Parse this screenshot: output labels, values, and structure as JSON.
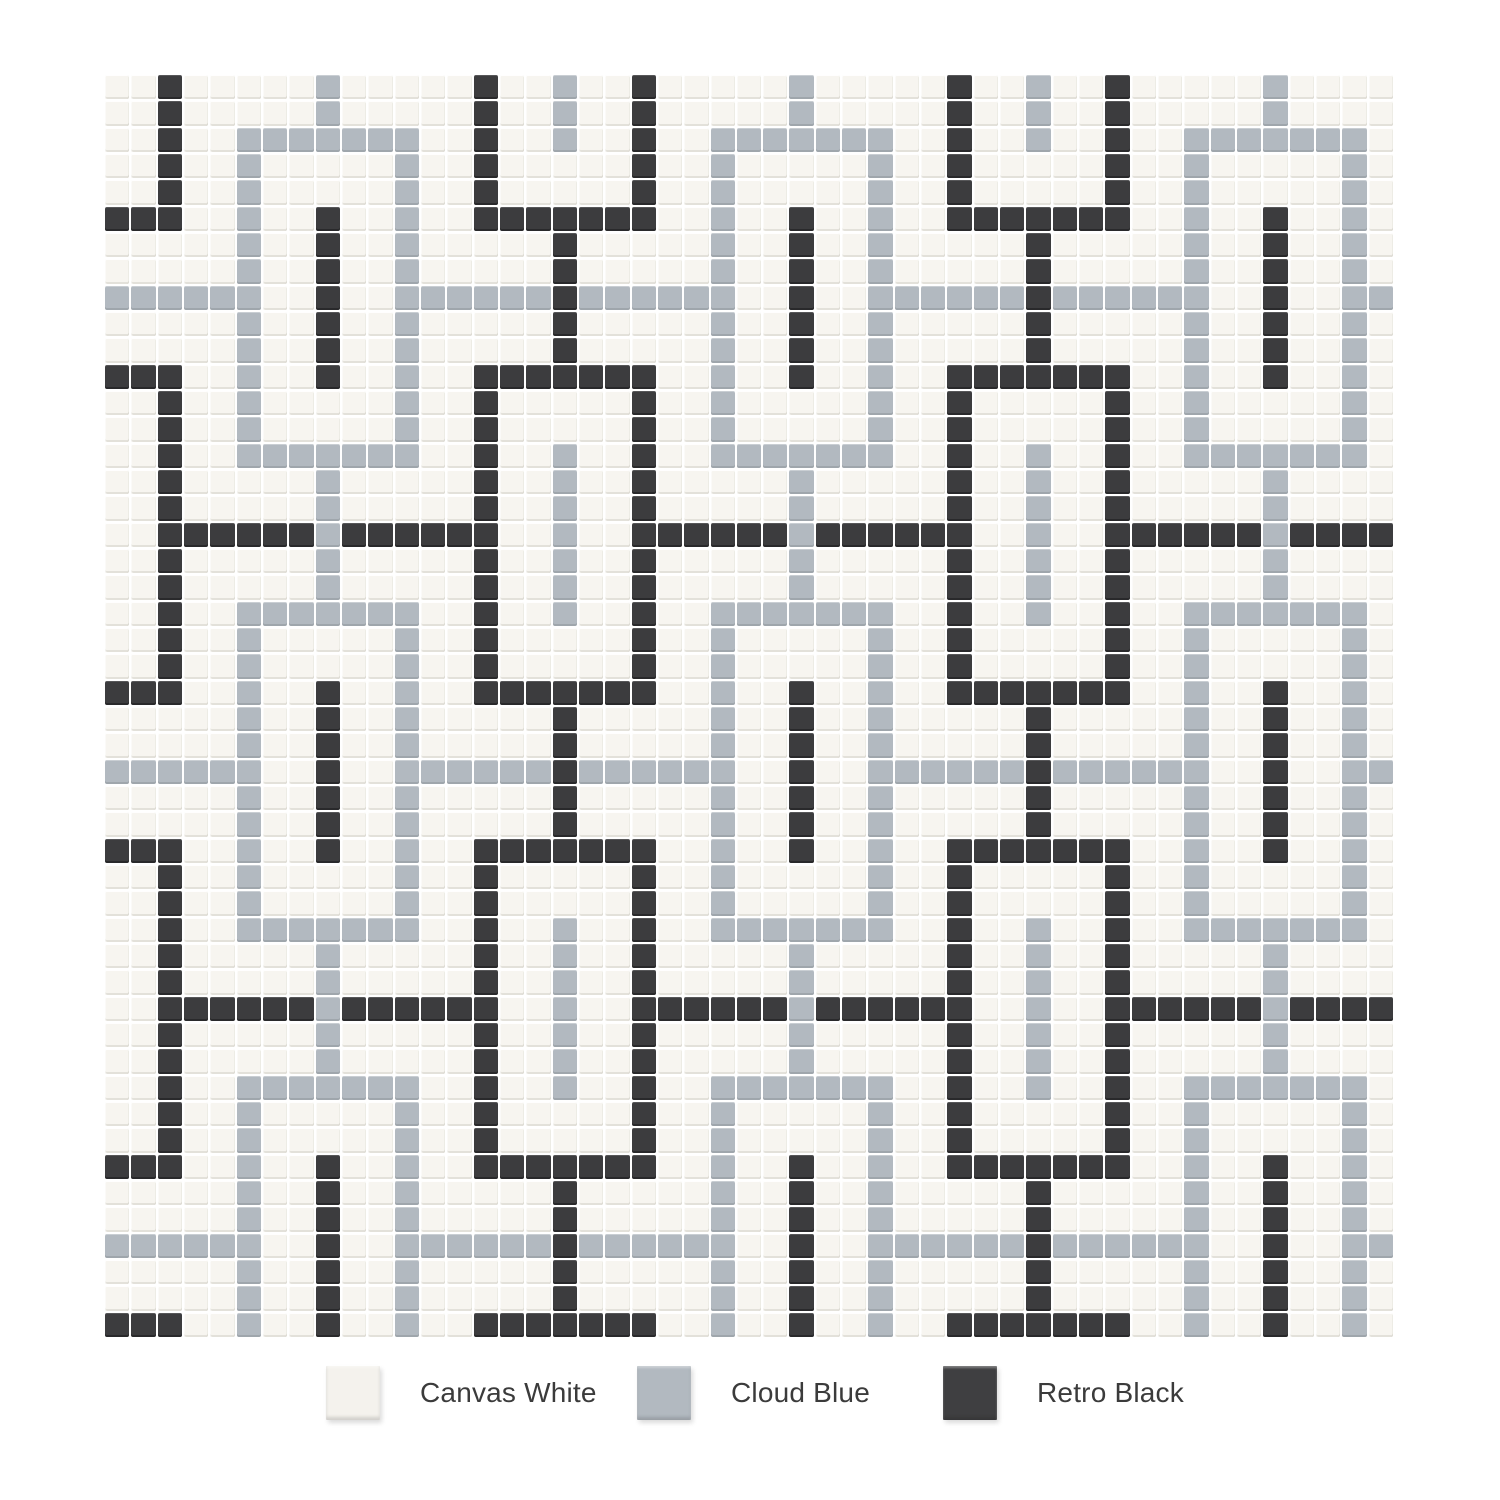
{
  "page": {
    "background": "#ffffff"
  },
  "mosaic": {
    "columns": 49,
    "rows": 48,
    "tile_gap_px": 2,
    "palette": {
      "W": "#f7f5f0",
      "B": "#b2b9c0",
      "D": "#3c3c3e"
    },
    "palette_names": {
      "W": "canvas-white",
      "B": "cloud-blue",
      "D": "retro-black"
    },
    "grid": [
      "WWDWWWWWBWWWWWDWWBWWDWWWWWBWWWWWDWWBWWDWWWWWBWWWW",
      "WWDWWWWWBWWWWWDWWBWWDWWWWWBWWWWWDWWBWWDWWWWWBWWWW",
      "WWDWWBBBBBBBWWDWWBWWDWWBBBBBBBWWDWWBWWDWWBBBBBBBW",
      "WWDWWBWWWWWBWWDWWWWWDWWBWWWWWBWWDWWWWWDWWBWWWWWBW",
      "WWDWWBWWWWWBWWDWWWWWDWWBWWWWWBWWDWWWWWDWWBWWWWWBW",
      "DDDWWBWWDWWBWWDDDDDDDWWBWWDWWBWWDDDDDDDWWBWWDWWBW",
      "WWWWWBWWDWWBWWWWWDWWWWWBWWDWWBWWWWWDWWWWWBWWDWWBW",
      "WWWWWBWWDWWBWWWWWDWWWWWBWWDWWBWWWWWDWWWWWBWWDWWBW",
      "BBBBBBWWDWWBBBBBBDBBBBBBWWDWWBBBBBBDBBBBBBWWDWWBB",
      "WWWWWBWWDWWBWWWWWDWWWWWBWWDWWBWWWWWDWWWWWBWWDWWBW",
      "WWWWWBWWDWWBWWWWWDWWWWWBWWDWWBWWWWWDWWWWWBWWDWWBW",
      "DDDWWBWWDWWBWWDDDDDDDWWBWWDWWBWWDDDDDDDWWBWWDWWBW",
      "WWDWWBWWWWWBWWDWWWWWDWWBWWWWWBWWDWWWWWDWWBWWWWWBW",
      "WWDWWBWWWWWBWWDWWWWWDWWBWWWWWBWWDWWWWWDWWBWWWWWBW",
      "WWDWWBBBBBBBWWDWWBWWDWWBBBBBBBWWDWWBWWDWWBBBBBBBW",
      "WWDWWWWWBWWWWWDWWBWWDWWWWWBWWWWWDWWBWWDWWWWWBWWWW",
      "WWDWWWWWBWWWWWDWWBWWDWWWWWBWWWWWDWWBWWDWWWWWBWWWW",
      "WWDDDDDDBDDDDDDWWBWWDDDDDDBDDDDDDWWBWWDDDDDDBDDDD",
      "WWDWWWWWBWWWWWDWWBWWDWWWWWBWWWWWDWWBWWDWWWWWBWWWW",
      "WWDWWWWWBWWWWWDWWBWWDWWWWWBWWWWWDWWBWWDWWWWWBWWWW",
      "WWDWWBBBBBBBWWDWWBWWDWWBBBBBBBWWDWWBWWDWWBBBBBBBW",
      "WWDWWBWWWWWBWWDWWWWWDWWBWWWWWBWWDWWWWWDWWBWWWWWBW",
      "WWDWWBWWWWWBWWDWWWWWDWWBWWWWWBWWDWWWWWDWWBWWWWWBW",
      "DDDWWBWWDWWBWWDDDDDDDWWBWWDWWBWWDDDDDDDWWBWWDWWBW",
      "WWWWWBWWDWWBWWWWWDWWWWWBWWDWWBWWWWWDWWWWWBWWDWWBW",
      "WWWWWBWWDWWBWWWWWDWWWWWBWWDWWBWWWWWDWWWWWBWWDWWBW",
      "BBBBBBWWDWWBBBBBBDBBBBBBWWDWWBBBBBBDBBBBBBWWDWWBB",
      "WWWWWBWWDWWBWWWWWDWWWWWBWWDWWBWWWWWDWWWWWBWWDWWBW",
      "WWWWWBWWDWWBWWWWWDWWWWWBWWDWWBWWWWWDWWWWWBWWDWWBW",
      "DDDWWBWWDWWBWWDDDDDDDWWBWWDWWBWWDDDDDDDWWBWWDWWBW",
      "WWDWWBWWWWWBWWDWWWWWDWWBWWWWWBWWDWWWWWDWWBWWWWWBW",
      "WWDWWBWWWWWBWWDWWWWWDWWBWWWWWBWWDWWWWWDWWBWWWWWBW",
      "WWDWWBBBBBBBWWDWWBWWDWWBBBBBBBWWDWWBWWDWWBBBBBBBW",
      "WWDWWWWWBWWWWWDWWBWWDWWWWWBWWWWWDWWBWWDWWWWWBWWWW",
      "WWDWWWWWBWWWWWDWWBWWDWWWWWBWWWWWDWWBWWDWWWWWBWWWW",
      "WWDDDDDDBDDDDDDWWBWWDDDDDDBDDDDDDWWBWWDDDDDDBDDDD",
      "WWDWWWWWBWWWWWDWWBWWDWWWWWBWWWWWDWWBWWDWWWWWBWWWW",
      "WWDWWWWWBWWWWWDWWBWWDWWWWWBWWWWWDWWBWWDWWWWWBWWWW",
      "WWDWWBBBBBBBWWDWWBWWDWWBBBBBBBWWDWWBWWDWWBBBBBBBW",
      "WWDWWBWWWWWBWWDWWWWWDWWBWWWWWBWWDWWWWWDWWBWWWWWBW",
      "WWDWWBWWWWWBWWDWWWWWDWWBWWWWWBWWDWWWWWDWWBWWWWWBW",
      "DDDWWBWWDWWBWWDDDDDDDWWBWWDWWBWWDDDDDDDWWBWWDWWBW",
      "WWWWWBWWDWWBWWWWWDWWWWWBWWDWWBWWWWWDWWWWWBWWDWWBW",
      "WWWWWBWWDWWBWWWWWDWWWWWBWWDWWBWWWWWDWWWWWBWWDWWBW",
      "BBBBBBWWDWWBBBBBBDBBBBBBWWDWWBBBBBBDBBBBBBWWDWWBB",
      "WWWWWBWWDWWBWWWWWDWWWWWBWWDWWBWWWWWDWWWWWBWWDWWBW",
      "WWWWWBWWDWWBWWWWWDWWWWWBWWDWWBWWWWWDWWWWWBWWDWWBW",
      "DDDWWBWWDWWBWWDDDDDDDWWBWWDWWBWWDDDDDDDWWBWWDWWBW"
    ]
  },
  "legend": {
    "items": [
      {
        "label": "Canvas White",
        "color": "#f4f2ed"
      },
      {
        "label": "Cloud Blue",
        "color": "#b2b9c0"
      },
      {
        "label": "Retro Black",
        "color": "#3f3f41"
      }
    ]
  }
}
